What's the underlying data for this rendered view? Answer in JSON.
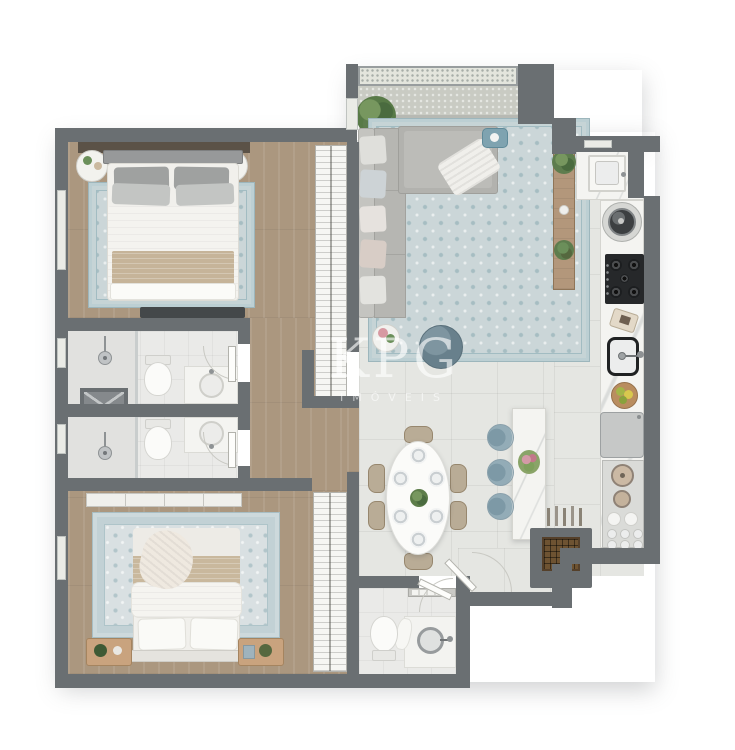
{
  "meta": {
    "type": "apartment-floor-plan-render",
    "view": "top-down-3d"
  },
  "watermark": {
    "brand": "KPG",
    "tagline": "IMÓVEIS"
  },
  "palette": {
    "background": "#ffffff",
    "wall": "#6a6f72",
    "wood_floor": "#ab977f",
    "tile_floor": "#e5e6e2",
    "balcony_floor": "#c9cbc3",
    "bath_floor": "#eaeae8",
    "rug_blue": "#cbd6d8",
    "sofa_gray": "#b6b6b2",
    "marble_white": "#f4f4f1",
    "stool_blue": "#92abb6",
    "cooktop_black": "#26282a",
    "wine_rack_brown": "#6e5332",
    "blanket_beige": "#c6b499",
    "plant_green": "#6b8f5a",
    "nightstand_wood": "#c9a37e"
  },
  "rooms": [
    {
      "id": "balcony",
      "contents": [
        "glass-railing",
        "potted-plant"
      ]
    },
    {
      "id": "living-room",
      "contents": [
        "l-shaped-sofa",
        "throw-pillows",
        "throw-blanket",
        "area-rug",
        "round-side-table",
        "pouf",
        "serving-tray",
        "sideboard",
        "plants"
      ]
    },
    {
      "id": "bedroom-1",
      "contents": [
        "double-bed",
        "nightstand-left",
        "nightstand-right",
        "area-rug",
        "tv-console",
        "built-in-closet"
      ]
    },
    {
      "id": "bathroom-1",
      "contents": [
        "shower",
        "toilet",
        "vanity-sink"
      ]
    },
    {
      "id": "duct-shaft",
      "contents": [
        "x-marked-shaft"
      ]
    },
    {
      "id": "bathroom-2",
      "contents": [
        "shower",
        "toilet",
        "vanity-sink"
      ]
    },
    {
      "id": "hallway",
      "contents": [
        "wood-floor"
      ]
    },
    {
      "id": "bedroom-2",
      "contents": [
        "double-bed",
        "nightstand-left",
        "nightstand-right",
        "area-rug",
        "wardrobe",
        "built-in-closet"
      ]
    },
    {
      "id": "dining-room",
      "contents": [
        "oval-table",
        "six-chairs",
        "six-place-settings",
        "centerpiece-plant"
      ]
    },
    {
      "id": "kitchen",
      "contents": [
        "island-counter",
        "three-bar-stools",
        "flower-vase",
        "cooktop",
        "sink",
        "cutting-board",
        "fruit-bowl",
        "refrigerator",
        "open-shelves",
        "pots",
        "plates",
        "cups",
        "wine-rack",
        "bottles"
      ]
    },
    {
      "id": "laundry",
      "contents": [
        "utility-sink",
        "washing-machine"
      ]
    },
    {
      "id": "powder-room",
      "contents": [
        "toilet",
        "round-basin-sink",
        "shelf-with-towels"
      ]
    },
    {
      "id": "entry",
      "contents": [
        "entry-door"
      ]
    }
  ],
  "counts": {
    "bedrooms": 2,
    "bathrooms": 3,
    "bar_stools": 3,
    "dining_chairs": 6
  }
}
